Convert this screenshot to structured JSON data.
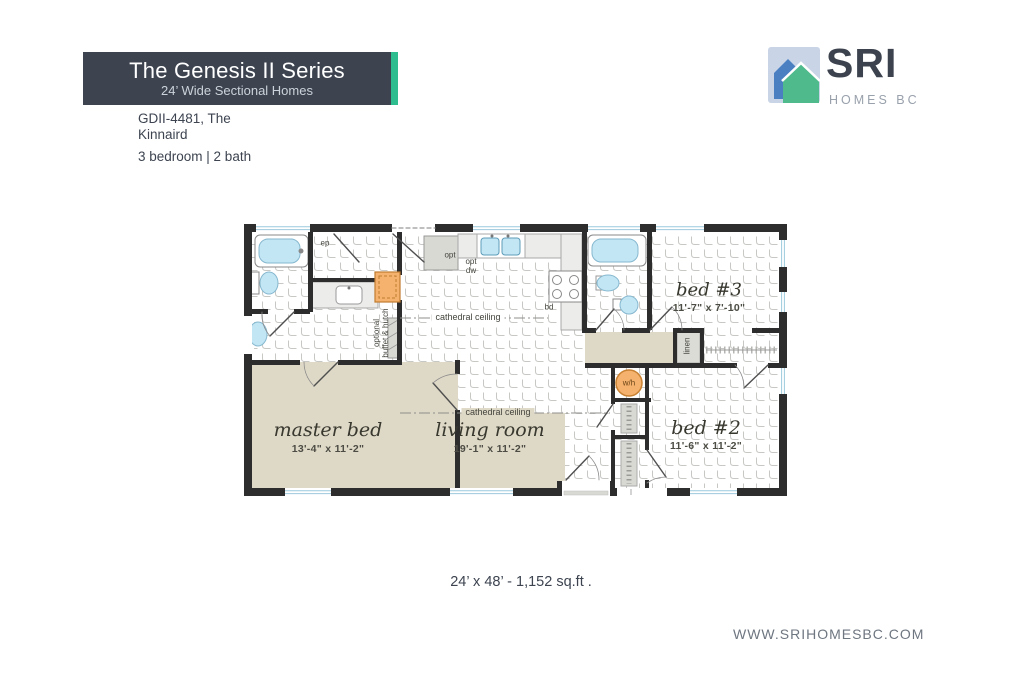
{
  "header": {
    "series_title": "The Genesis II Series",
    "series_subtitle": "24’ Wide Sectional Homes",
    "model_line1": "GDII-4481, The",
    "model_line2": "Kinnaird",
    "specs": "3 bedroom | 2 bath"
  },
  "logo": {
    "name": "SRI",
    "tagline": "HOMES BC"
  },
  "floorplan": {
    "rooms": [
      {
        "name": "master bed",
        "dims": "13'-4\" x 11'-2\""
      },
      {
        "name": "living room",
        "dims": "19'-1\" x 11'-2\""
      },
      {
        "name": "bed #2",
        "dims": "11'-6\" x 11'-2\""
      },
      {
        "name": "bed #3",
        "dims": "11'-7\" x 7'-10\""
      }
    ],
    "annotations": {
      "cathedral_kitchen": "cathedral ceiling",
      "cathedral_living": "cathedral ceiling",
      "buffet_line1": "optional",
      "buffet_line2": "buffet & hutch",
      "linen": "linen",
      "water_heater": "w/h",
      "opt": "opt",
      "opt_dw_line1": "opt",
      "opt_dw_line2": "dw",
      "ep": "ep",
      "bd": "bd"
    }
  },
  "footer": {
    "dimensions": "24’ x 48’ - 1,152 sq.ft .",
    "website": "WWW.SRIHOMESBC.COM"
  },
  "colors": {
    "header_box": "#3d4450",
    "accent_green": "#2ebd8f",
    "wall": "#2d2d2d",
    "carpet_beige": "#ded8c6",
    "fixture_blue": "#c3e6f4",
    "cabinet_orange": "#f5b26e"
  }
}
